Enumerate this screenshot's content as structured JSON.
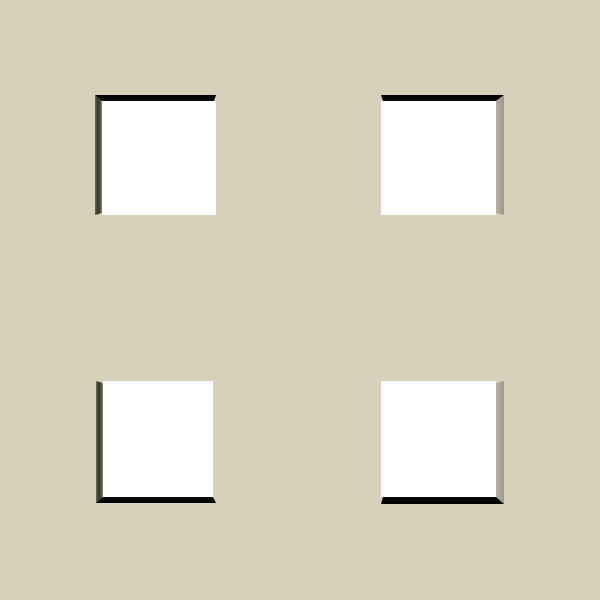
{
  "scene": {
    "description": "Beige matboard-style wall with four white square recessed openings arranged in a 2x2 grid; each opening shows two dark beveled shadow walls on the edges facing the nearest outer corner, joined by a 45-degree miter",
    "background_color": "#d7d1bb",
    "colors": {
      "backdrop_white": "#ffffff",
      "shadow_black": "#0b0b08",
      "shadow_dark_olive": "#3a372c",
      "shadow_dark_olive_outer": "#6e6a5e",
      "shadow_dark_olive_inner": "#8f8b7d",
      "shadow_gray": "#a9a396",
      "shadow_gray_light": "#b7b1a4",
      "shadow_gray_dark": "#9f998b"
    },
    "grid": {
      "rows": 2,
      "cols": 2,
      "count": 4
    },
    "squares": [
      {
        "id": "top-left",
        "x": 95,
        "y": 95,
        "width": 121,
        "height": 120,
        "shadow_edges": [
          "top",
          "left"
        ]
      },
      {
        "id": "top-right",
        "x": 381,
        "y": 95,
        "width": 123,
        "height": 120,
        "shadow_edges": [
          "top",
          "right"
        ]
      },
      {
        "id": "bottom-left",
        "x": 96,
        "y": 381,
        "width": 120,
        "height": 122,
        "shadow_edges": [
          "left",
          "bottom"
        ]
      },
      {
        "id": "bottom-right",
        "x": 381,
        "y": 381,
        "width": 123,
        "height": 123,
        "shadow_edges": [
          "right",
          "bottom"
        ]
      }
    ]
  }
}
